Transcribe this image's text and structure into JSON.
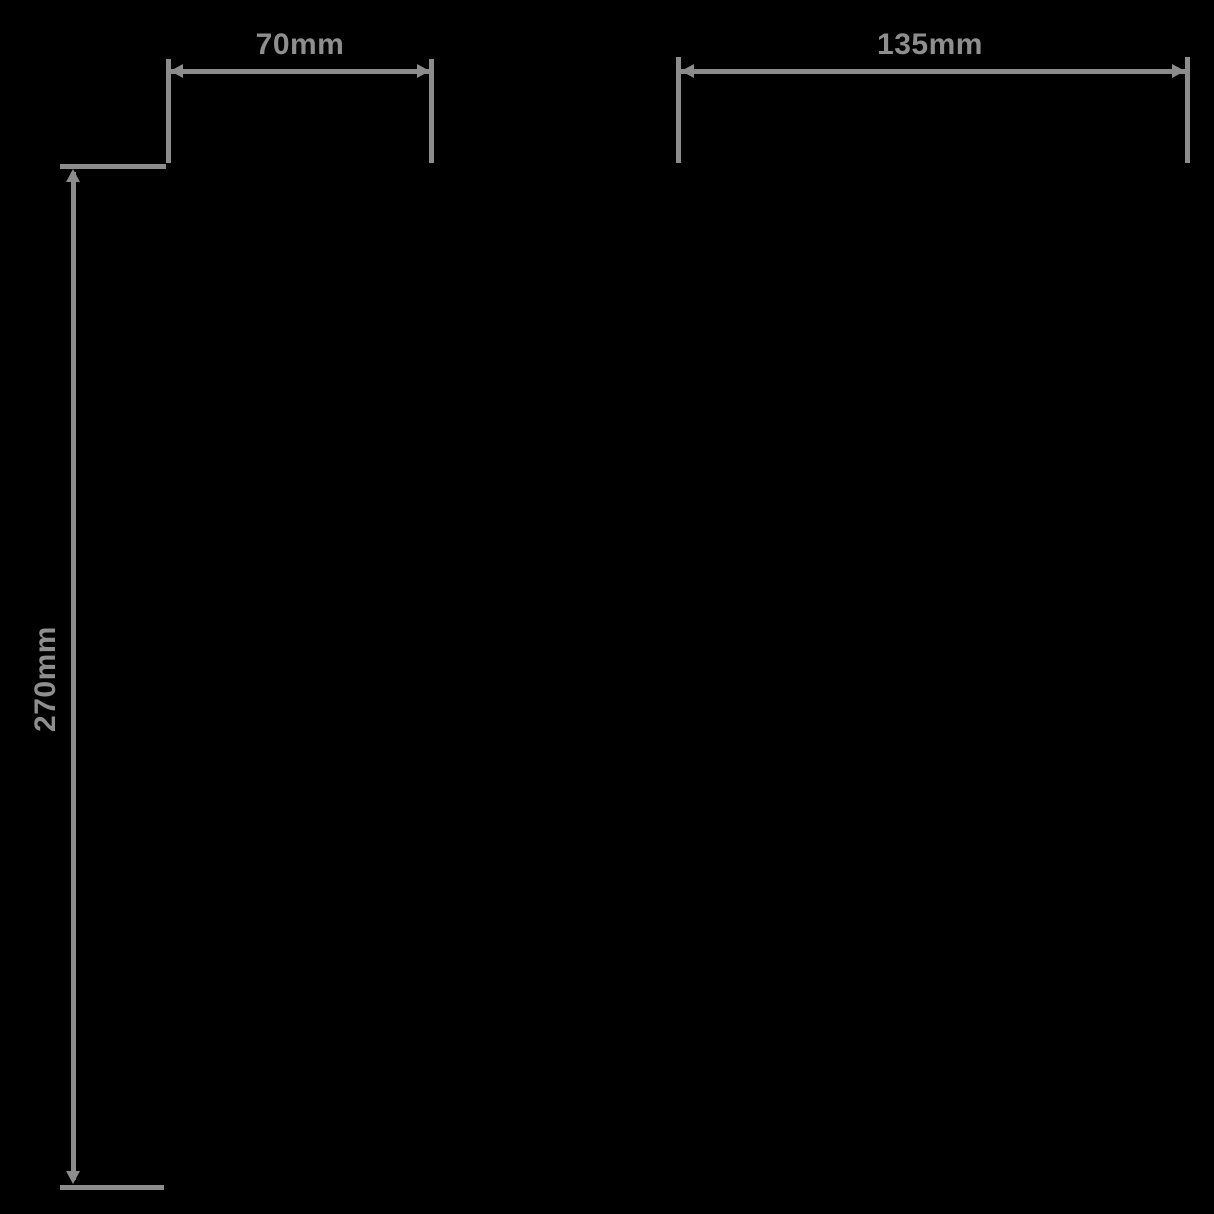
{
  "diagram": {
    "type": "product-dimension-drawing",
    "colors": {
      "background": "#000000",
      "line": "#8c8c8c",
      "text": "#8e8e8e"
    },
    "dimensions": [
      {
        "id": "top-left-width",
        "label": "70mm",
        "orientation": "horizontal"
      },
      {
        "id": "top-right-width",
        "label": "135mm",
        "orientation": "horizontal"
      },
      {
        "id": "left-height",
        "label": "270mm",
        "orientation": "vertical"
      }
    ]
  }
}
